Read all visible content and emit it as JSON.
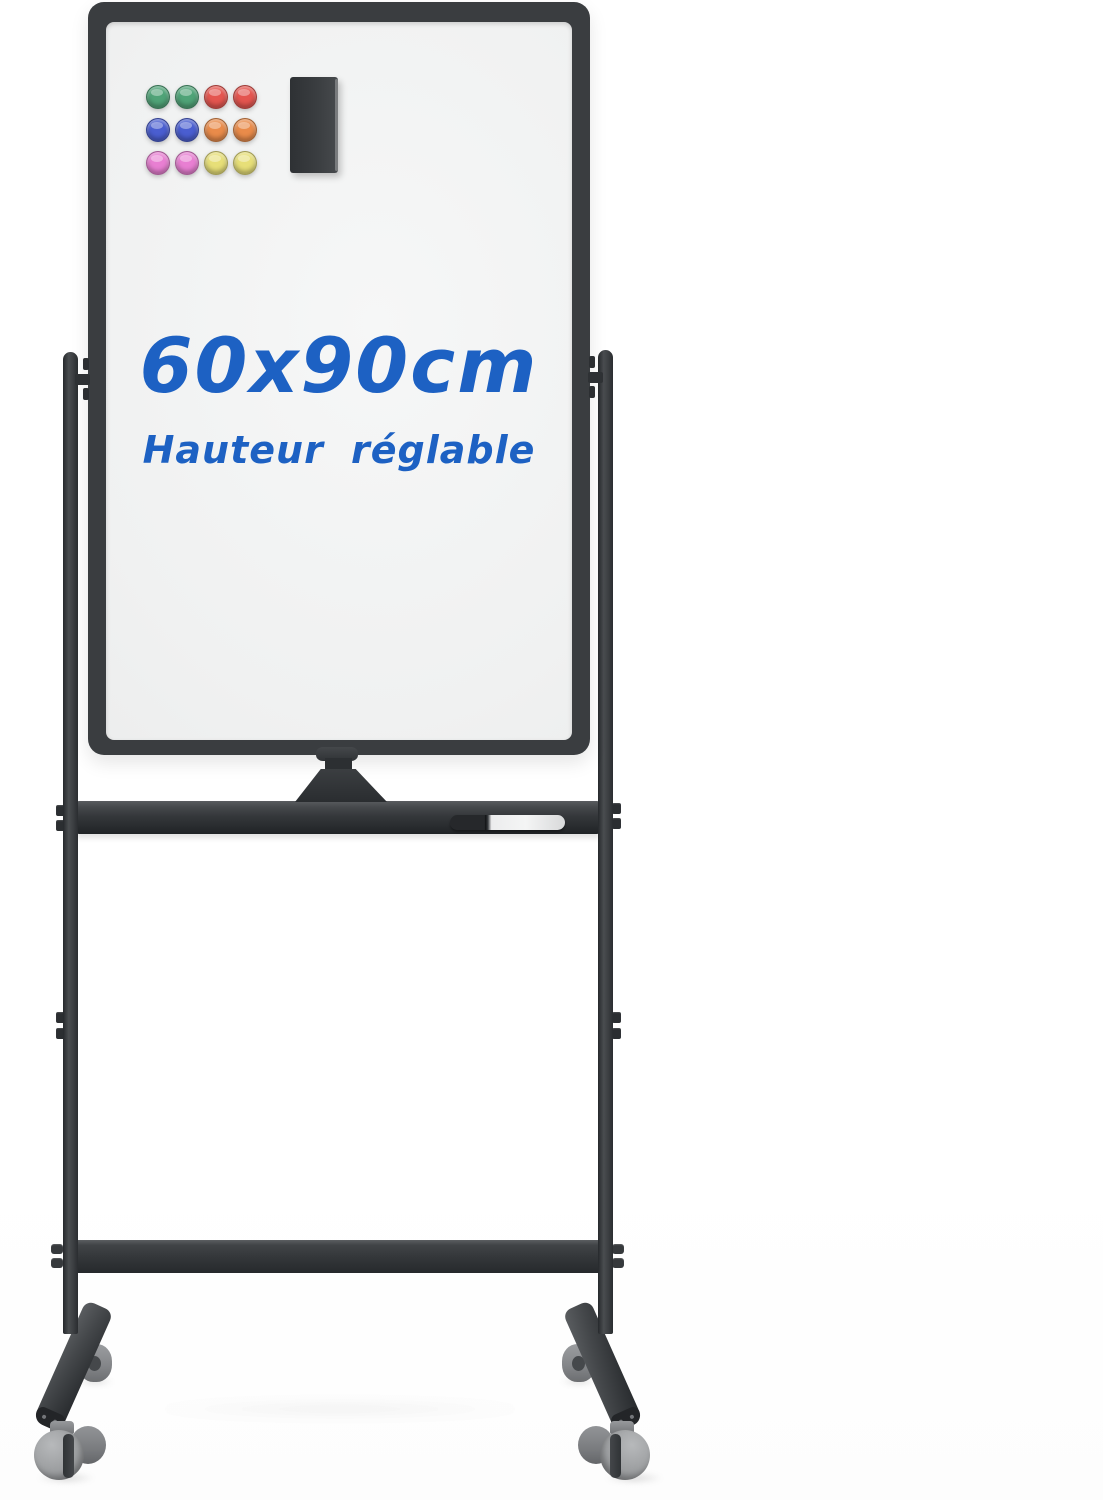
{
  "annotation": {
    "size_label": "60x90cm",
    "subtitle": "Hauteur réglable",
    "text_color": "#1d61c3"
  },
  "board": {
    "frame_color": "#3a3d40",
    "surface_color": "#f0f1f1"
  },
  "stand": {
    "metal_color": "#35383b",
    "caster_color": "#9c9ea0"
  },
  "magnets": {
    "palette": {
      "green": "#4fa377",
      "red": "#e4554f",
      "blue": "#4a5ed0",
      "orange": "#e98b4a",
      "pink": "#e87fd2",
      "yellow": "#e7df78"
    },
    "rows": [
      [
        "green",
        "green",
        "red",
        "red"
      ],
      [
        "blue",
        "blue",
        "orange",
        "orange"
      ],
      [
        "pink",
        "pink",
        "yellow",
        "yellow"
      ]
    ]
  },
  "accessories": {
    "eraser": "magnetic-eraser",
    "marker": "dry-erase-marker"
  }
}
